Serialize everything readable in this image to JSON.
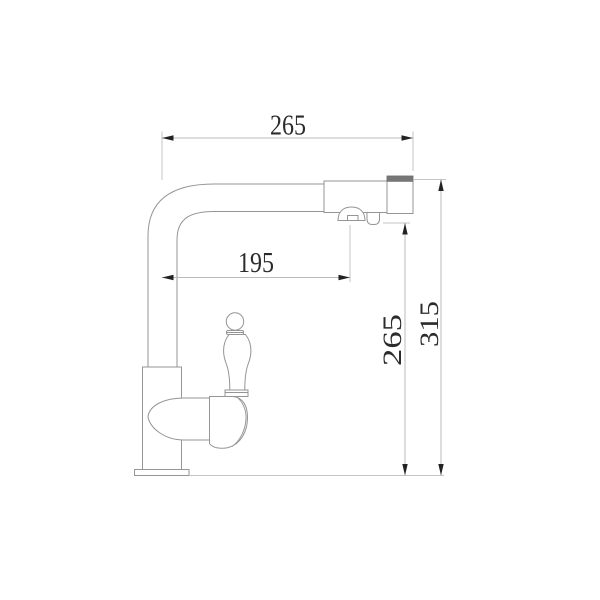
{
  "drawing": {
    "kind": "technical-dimension-drawing",
    "dimensions": {
      "top_width": "265",
      "spout_reach": "195",
      "outlet_height": "265",
      "overall_height": "315"
    },
    "colors": {
      "background": "#ffffff",
      "faucet_outline": "#959595",
      "aerator_band": "#777777",
      "dimension_lines": "#bbbbbb",
      "arrows": "#222222",
      "dimension_text": "#2b2b2b"
    }
  }
}
